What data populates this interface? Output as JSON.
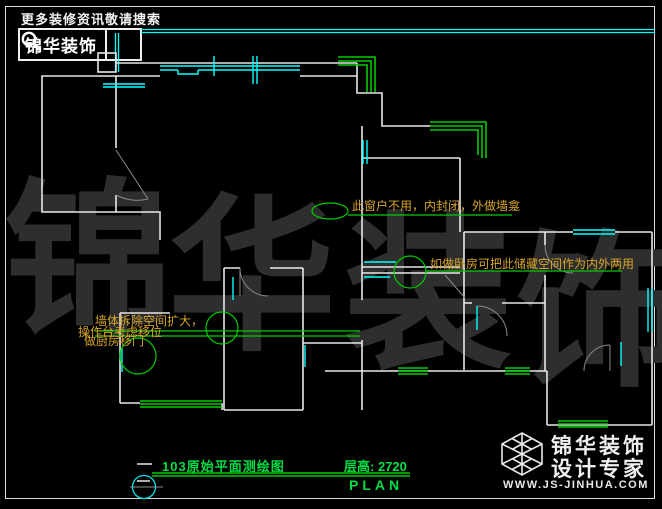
{
  "header": {
    "slogan": "更多装修资讯敬请搜索",
    "brand": "锦华装饰",
    "search_icon": "magnifier-icon"
  },
  "watermark": {
    "chars": [
      "锦",
      "华",
      "装",
      "饰"
    ]
  },
  "annotations": {
    "window_note": "此窗户不用，内封闭，外做墙龛",
    "storage_note": "如做卧房可把此储藏空间作为内外两用",
    "kitchen_line1": "墙体拆除空间扩大，",
    "kitchen_line2": "操作台考虑移位",
    "kitchen_line3": "做厨房移门"
  },
  "title_block": {
    "drawing_title": "103原始平面测绘图",
    "floor_height": "层高: 2720",
    "plan_label": "PLAN"
  },
  "footer_logo": {
    "brand_line1": "锦华装饰",
    "brand_line2": "设计专家",
    "website": "WWW.JS-JINHUA.COM"
  },
  "colors": {
    "wall_white": "#e8e8e8",
    "window_cyan": "#00ffff",
    "line_green": "#00cc00",
    "text_green": "#00dd44",
    "annotation_yellow": "#d7a52a",
    "watermark_gray": "#2e2e2e"
  }
}
